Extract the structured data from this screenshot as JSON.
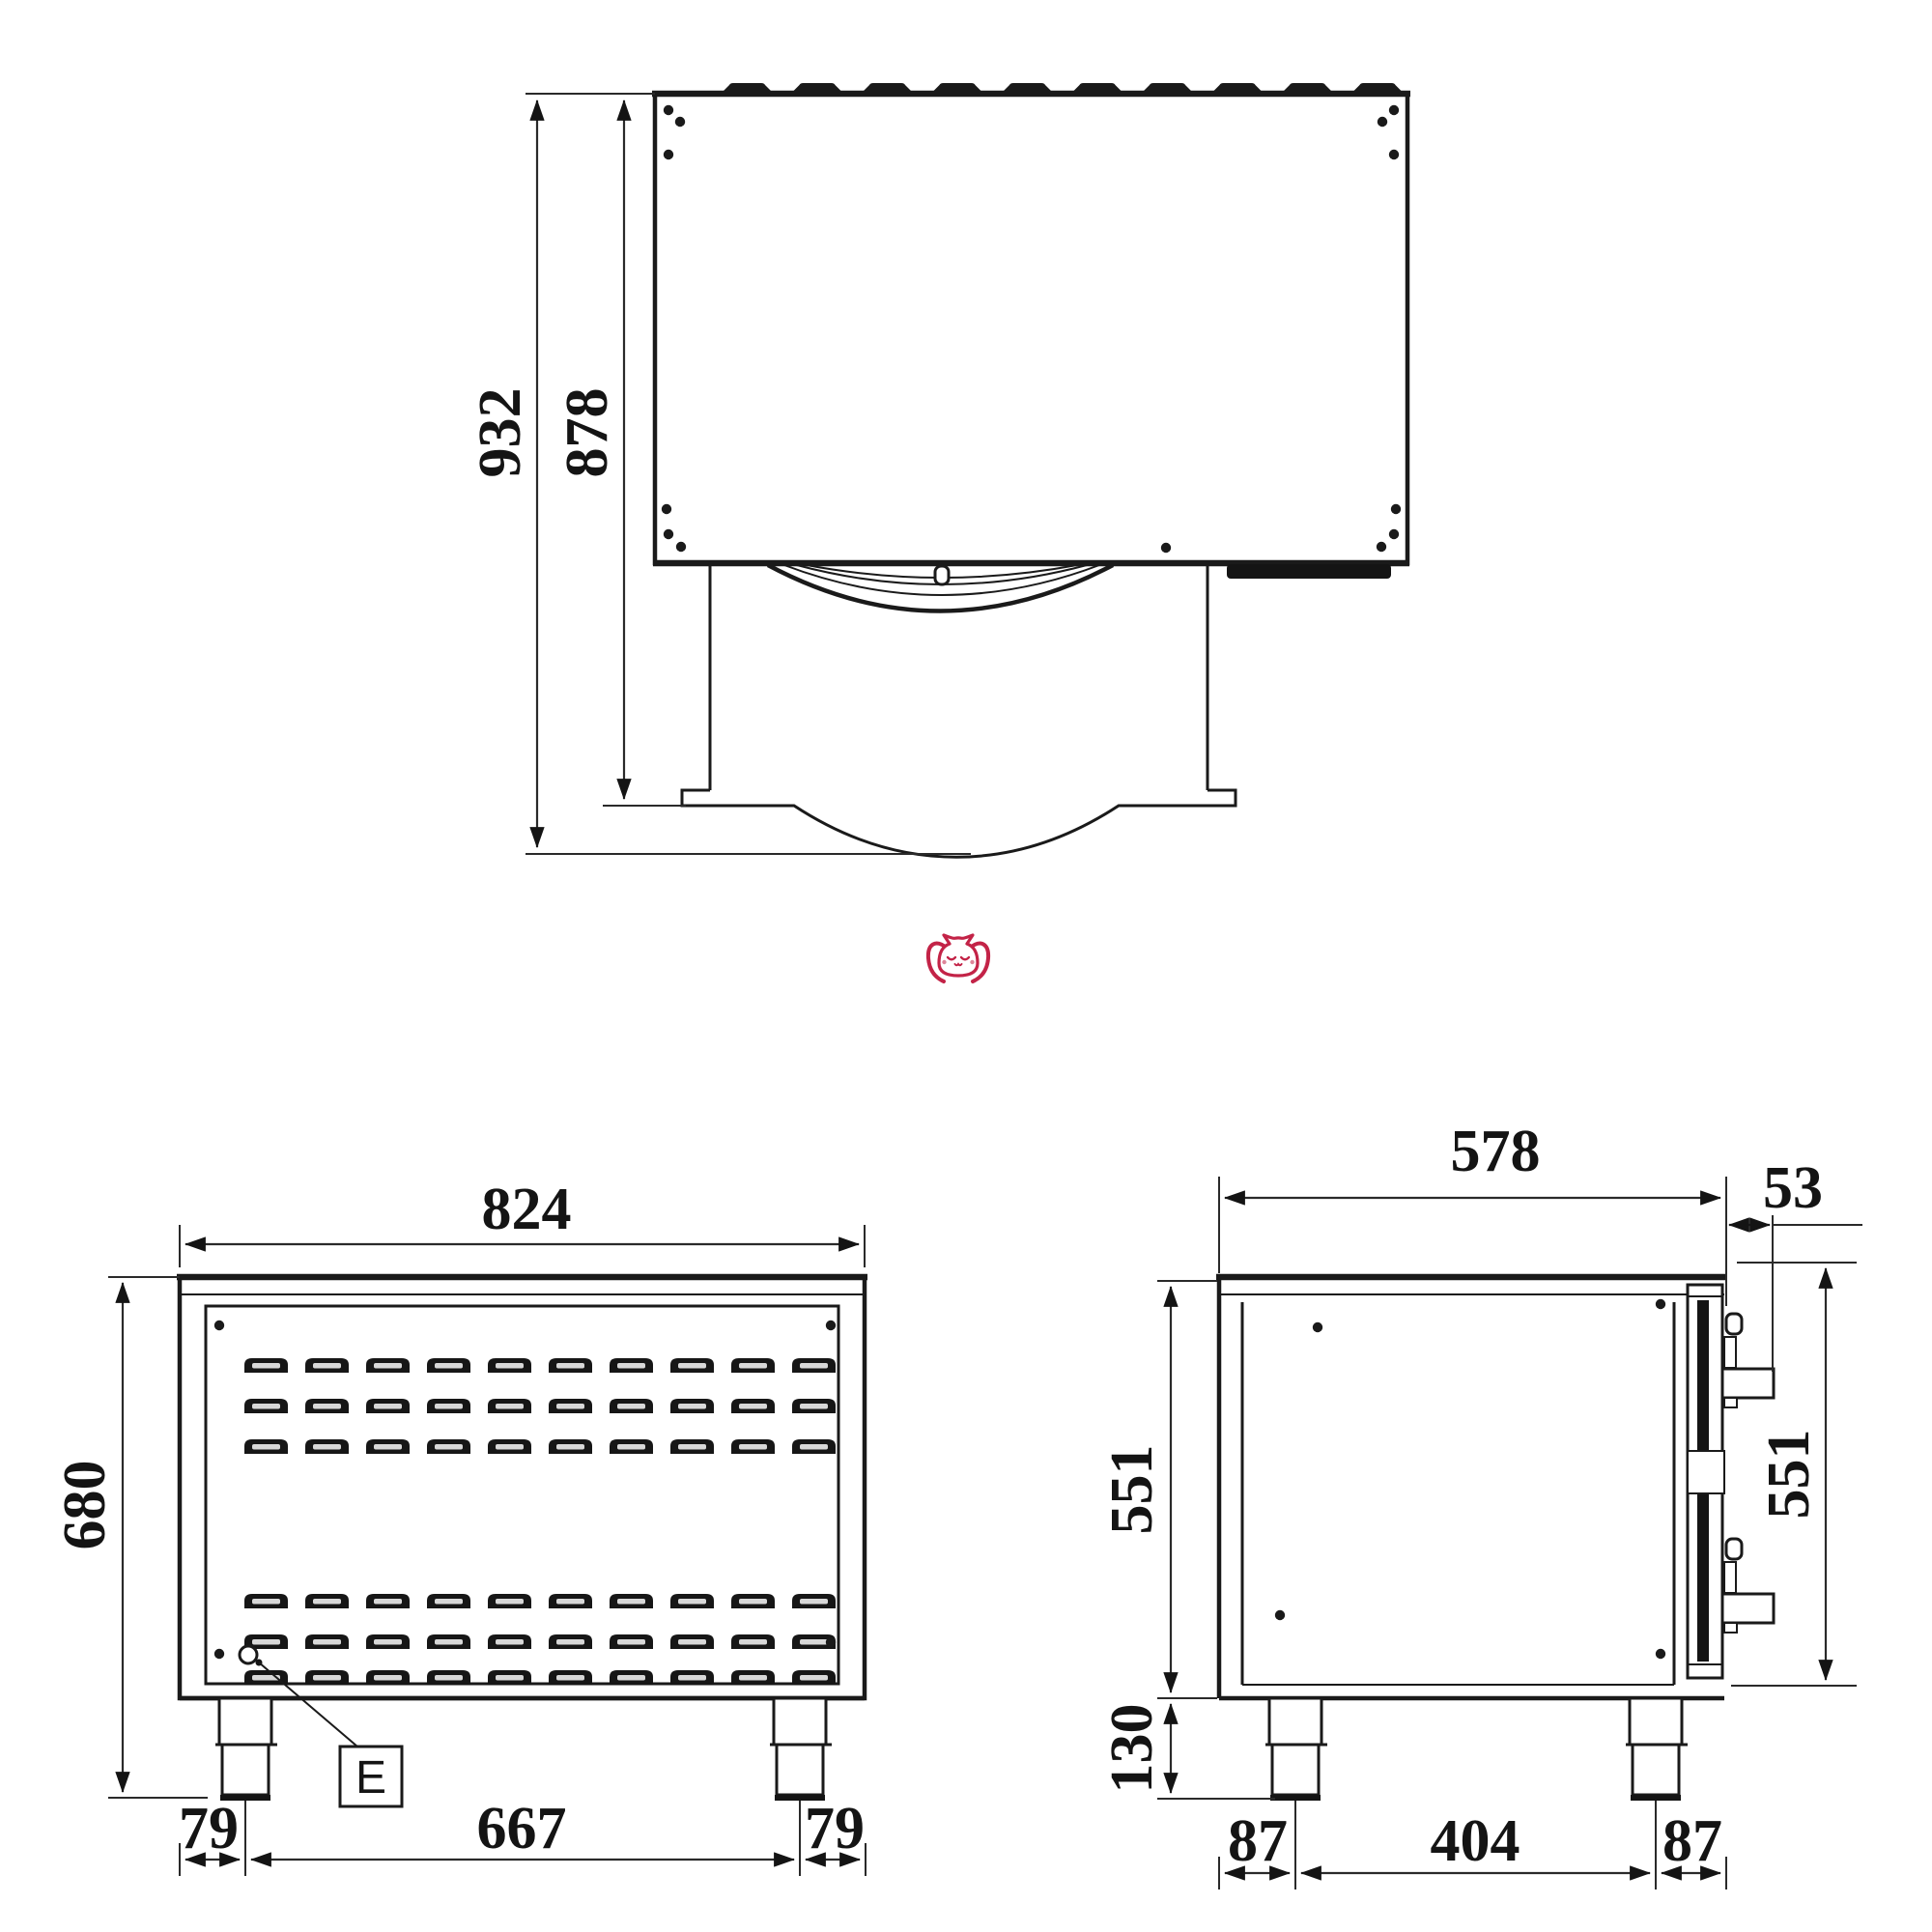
{
  "title": "Oven technical drawing - three views",
  "colors": {
    "line": "#1a1a1a",
    "logo": "#c32347"
  },
  "top_view": {
    "dim_total_depth": "932",
    "dim_body_depth": "878",
    "vent_tab_count": 10
  },
  "front_view": {
    "dim_width": "824",
    "dim_height": "680",
    "dim_leg_left": "79",
    "dim_leg_span": "667",
    "dim_leg_right": "79",
    "detail_label": "E",
    "vent_columns": 10,
    "vent_rows": 6
  },
  "side_view": {
    "dim_depth": "578",
    "dim_door_offset": "53",
    "dim_body_height": "551",
    "dim_door_height": "551",
    "dim_leg_height": "130",
    "dim_front_offset": "87",
    "dim_leg_span": "404",
    "dim_back_offset": "87"
  }
}
